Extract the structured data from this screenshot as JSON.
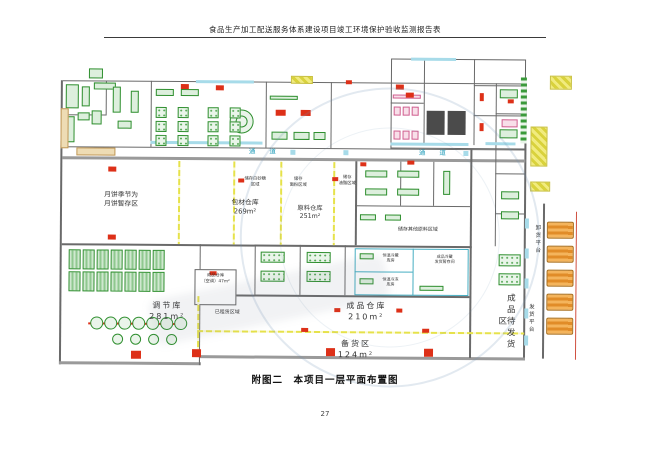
{
  "page": {
    "header": "食品生产加工配送服务体系建设项目竣工环境保护验收监测报告表",
    "caption": "附图二　本项目一层平面布置图",
    "page_number": "27"
  },
  "plan": {
    "corridor_label_left": "通 道",
    "corridor_label_right": "通 道",
    "rooms": {
      "mooncake": "月饼季节为\n月饼暂存区",
      "packaging_warehouse": "包材仓库\n269m²",
      "raw_warehouse": "原料仓库\n251m²",
      "zone_sugar": "储存白砂糖\n区域",
      "zone_flour": "储存\n面粉区域",
      "zone_oil": "储存\n油脂区域",
      "zone_other": "储存其他原料区域",
      "finished_warehouse": "成品仓库\n210m²",
      "stock_area": "备货区\n124m²",
      "regulating_warehouse": "调节库\n281m²",
      "finished_small": "成品仓库\n（空调）47m²",
      "leased": "已租赁区域",
      "awaiting_shipment": "成品待发货区",
      "shipping_platform": "发货平台",
      "unloading_platform": "卸货平台",
      "cold_storage": "恒温冷藏\n库房",
      "freezer": "恒温冷冻\n库房",
      "cold_shipping_buffer": "成品冷藏\n发货暂存间"
    }
  },
  "colors": {
    "accent_green": "#2f8f2f",
    "marker_red": "#dd3018",
    "line_yellow": "#e8e44a",
    "corridor_cyan": "#2aa0bc",
    "truck_orange": "#f0a445"
  }
}
